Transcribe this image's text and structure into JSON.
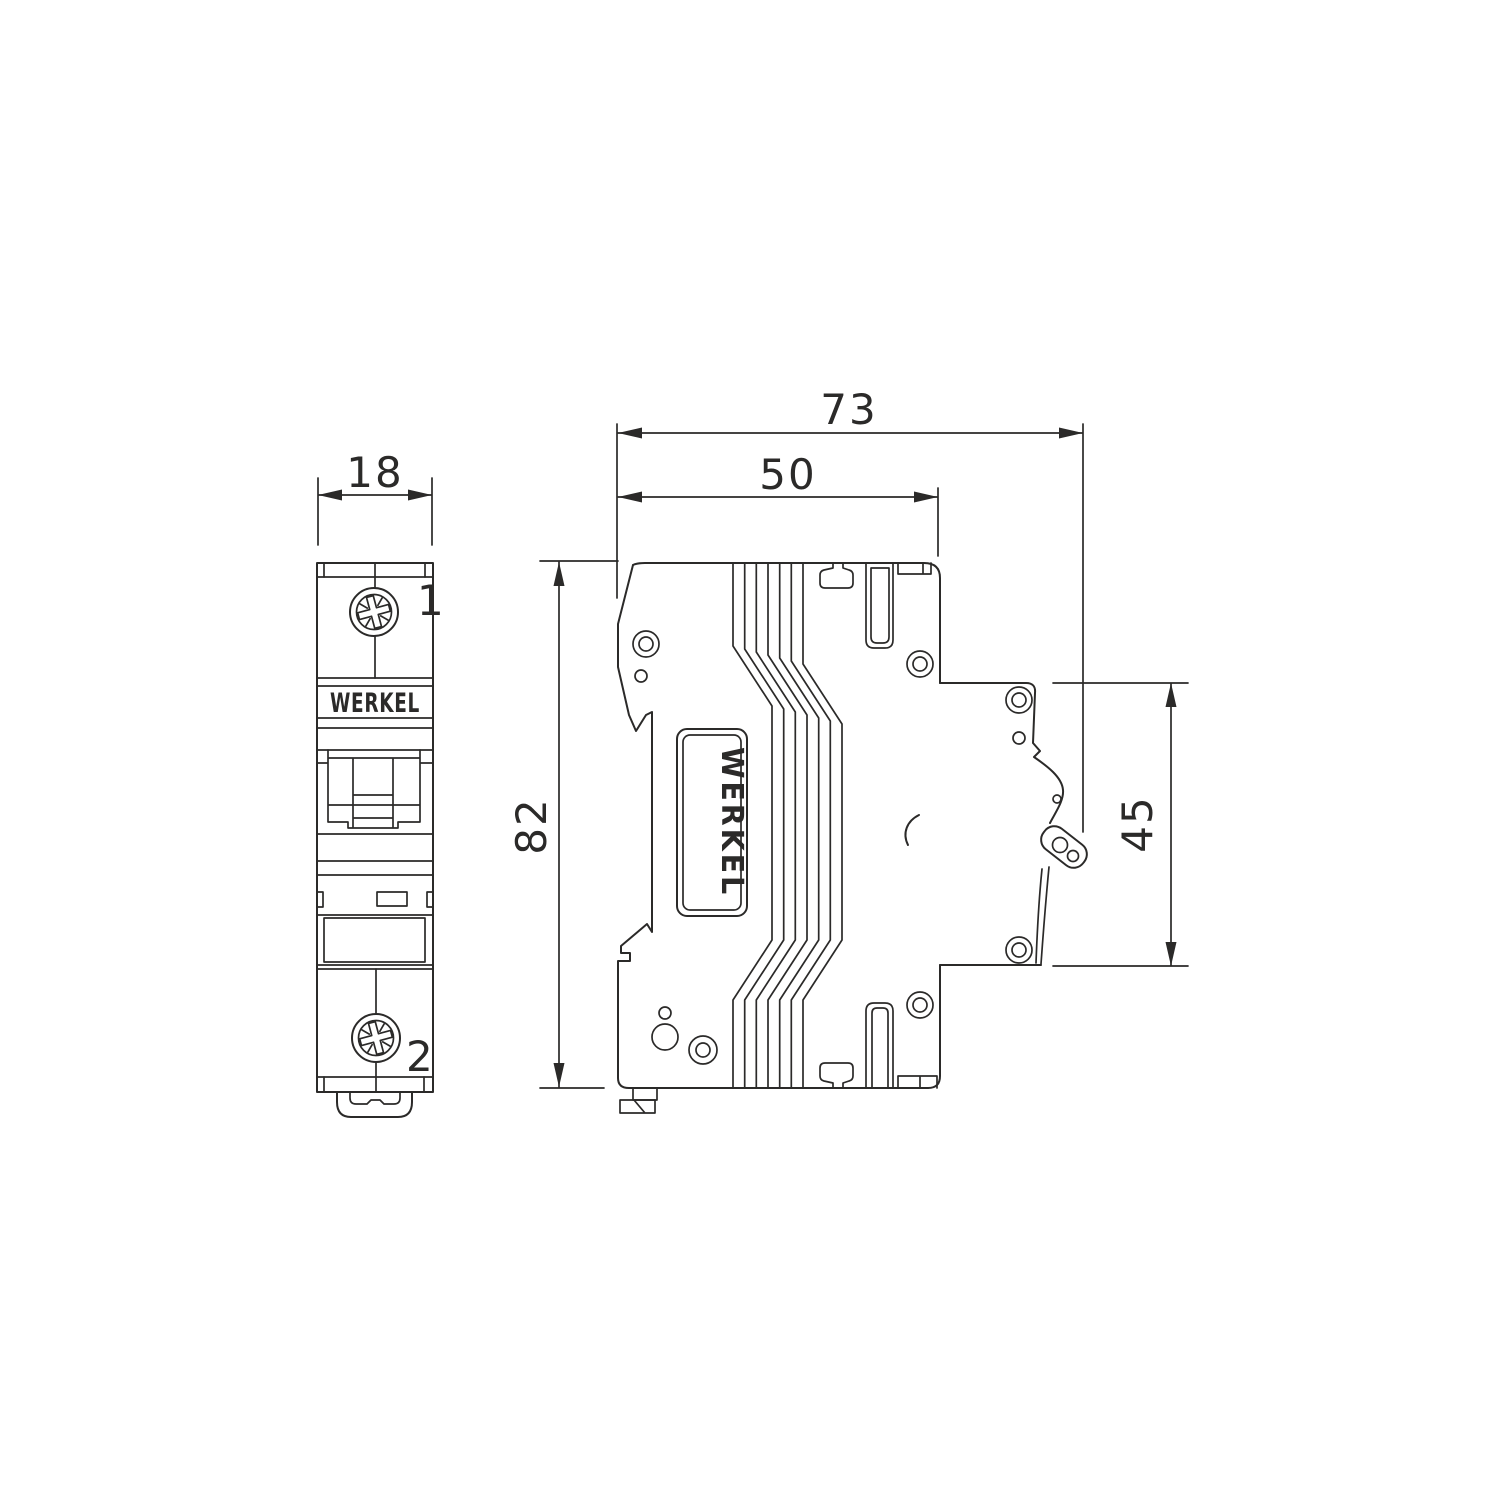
{
  "drawing": {
    "type": "technical dimensional drawing",
    "subject": "single-pole modular circuit breaker",
    "brand": "WERKEL",
    "colors": {
      "background": "#ffffff",
      "line": "#2b2a29"
    },
    "front_view": {
      "brand_label": "WERKEL",
      "terminal_top": "1",
      "terminal_bottom": "2",
      "width_mm": "18"
    },
    "side_view": {
      "brand_label": "WERKEL",
      "overall_depth_mm": "73",
      "body_depth_mm": "50",
      "height_mm": "82",
      "panel_height_mm": "45"
    }
  }
}
